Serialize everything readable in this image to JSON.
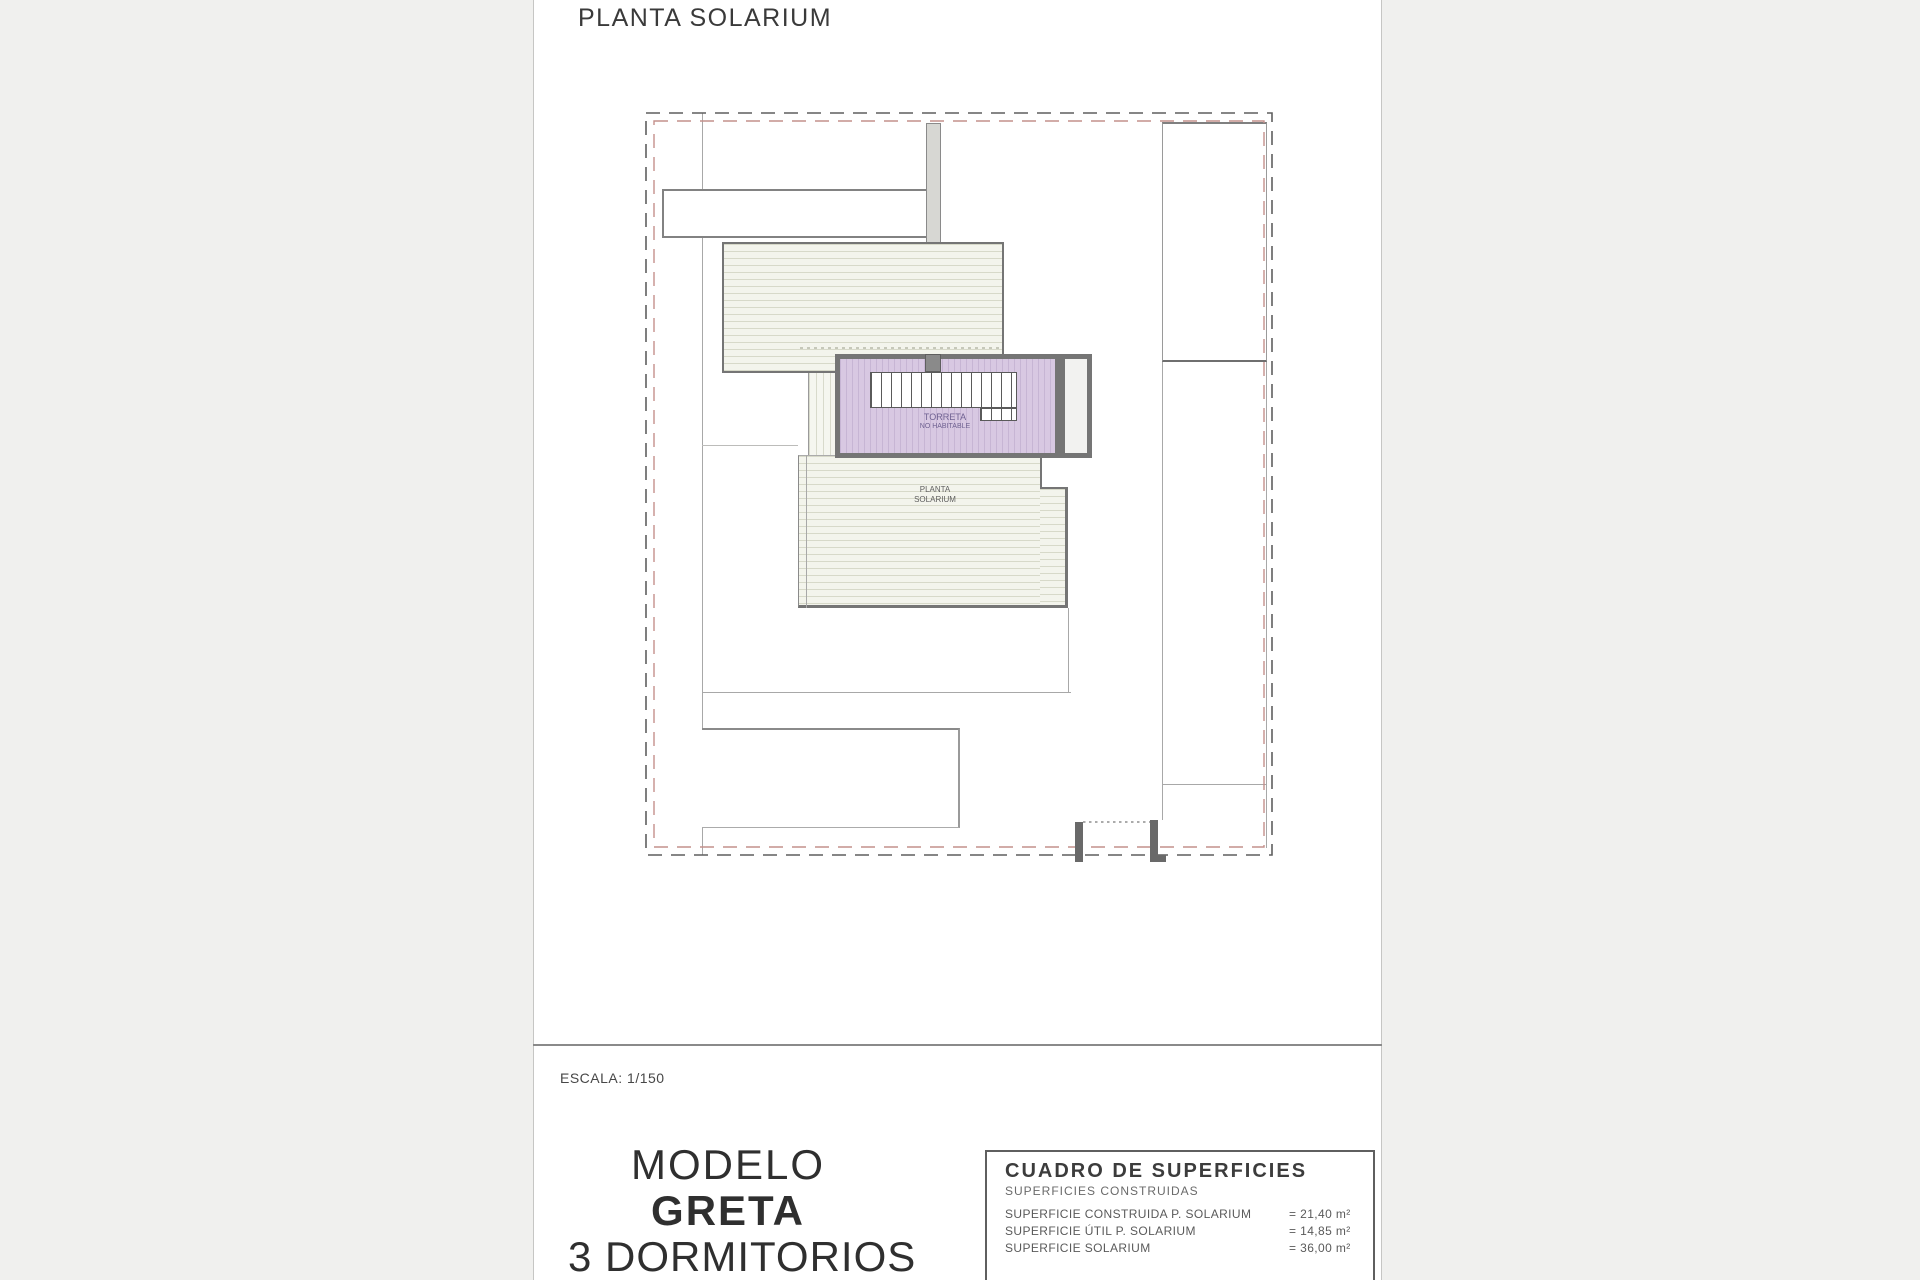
{
  "header": {
    "title": "PLANTA SOLARIUM"
  },
  "footer": {
    "scale": "ESCALA: 1/150",
    "model_line1": "MODELO",
    "model_line2": "GRETA",
    "model_line3": "3 DORMITORIOS"
  },
  "plan_labels": {
    "torreta_line1": "TORRETA",
    "torreta_line2": "NO HABITABLE",
    "solarium_line1": "PLANTA",
    "solarium_line2": "SOLARIUM"
  },
  "surfaces_table": {
    "title": "CUADRO DE SUPERFICIES",
    "subtitle": "SUPERFICIES CONSTRUIDAS",
    "rows": [
      {
        "label": "SUPERFICIE CONSTRUIDA P. SOLARIUM",
        "value": "= 21,40 m²"
      },
      {
        "label": "SUPERFICIE ÚTIL P. SOLARIUM",
        "value": "= 14,85 m²"
      },
      {
        "label": "SUPERFICIE SOLARIUM",
        "value": "= 36,00 m²"
      }
    ]
  },
  "colors": {
    "boundary_dash_primary": "#5f5f5f",
    "boundary_dash_secondary": "#c4908c",
    "torreta_fill": "#d8c8e2",
    "roof_hatch_fill": "#f3f4ec",
    "wall_dark": "#757575",
    "door_jamb": "#696969"
  }
}
